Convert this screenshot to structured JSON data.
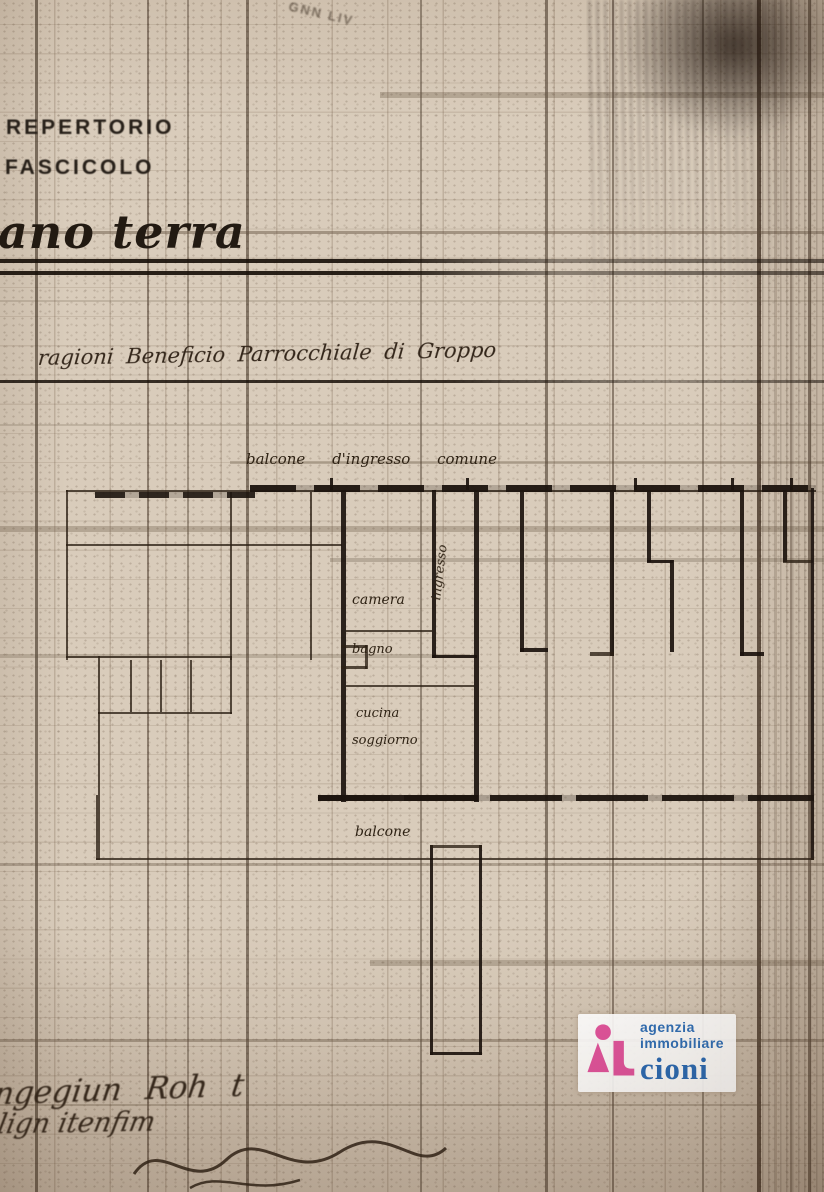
{
  "page": {
    "header": {
      "repertorio": "REPERTORIO",
      "fascicolo": "FASCICOLO"
    },
    "floor_title": "ano terra",
    "faint_top_text": "GNN LIV",
    "ragioni_line": "ragioni Beneficio Parrocchiale di Groppo",
    "plan": {
      "balcony_entry_label": "balcone   d'ingresso   comune",
      "rooms": {
        "ingresso": "ingresso",
        "camera": "camera",
        "bagno": "bagno",
        "cucina": "cucina",
        "soggiorno": "soggiorno",
        "balcone": "balcone"
      }
    },
    "handwriting": {
      "line1": "ngegiun Roh t",
      "line2": "lign itenfim"
    }
  },
  "watermark": {
    "agency_line1": "agenzia",
    "agency_line2": "immobiliare",
    "agency_name": "cioni",
    "pink": "#e0539b",
    "blue": "#2f6eb5"
  }
}
